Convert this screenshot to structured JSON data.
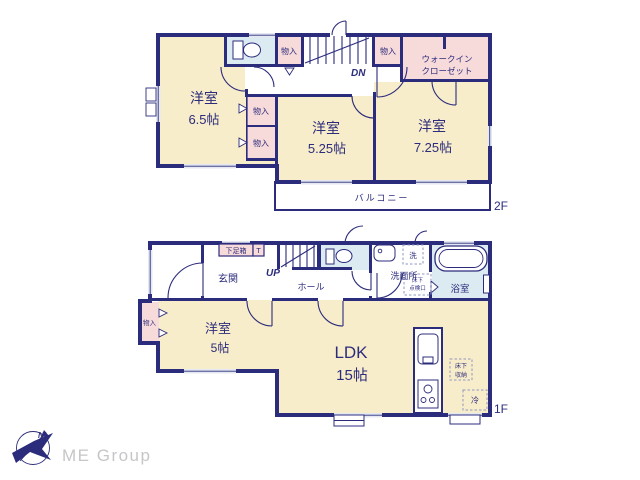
{
  "colors": {
    "wall": "#2c2c7c",
    "cream": "#f8edca",
    "pink": "#f7dada",
    "wet": "#dceaf2",
    "win": "#e4e8f2",
    "dash": "#8f97c0",
    "logo_gray": "#c6c6ca"
  },
  "f2": {
    "floor_label": "2F",
    "bedroom_a_name": "洋室",
    "bedroom_a_size": "6.5帖",
    "bedroom_b_name": "洋室",
    "bedroom_b_size": "5.25帖",
    "bedroom_c_name": "洋室",
    "bedroom_c_size": "7.25帖",
    "wic_line1": "ウォークイン",
    "wic_line2": "クローゼット",
    "closet_top_left": "物入",
    "closet_top_right": "物入",
    "closet_mid_upper": "物入",
    "closet_mid_lower": "物入",
    "balcony": "バルコニー",
    "stairs_down": "DN"
  },
  "f1": {
    "floor_label": "1F",
    "entrance": "玄関",
    "shoe_box": "下足箱",
    "shoe_box_t": "T",
    "stairs_up": "UP",
    "hall": "ホール",
    "laundry": "洗",
    "washroom": "洗面所",
    "hatch_line1": "床下",
    "hatch_line2": "点検口",
    "bath": "浴室",
    "closet": "物入",
    "bedroom_name": "洋室",
    "bedroom_size": "5帖",
    "ldk_name": "LDK",
    "ldk_size": "15帖",
    "floor_storage_line1": "床下",
    "floor_storage_line2": "収納",
    "fridge": "冷"
  },
  "logo": {
    "company": "ME Group",
    "north": "N"
  }
}
